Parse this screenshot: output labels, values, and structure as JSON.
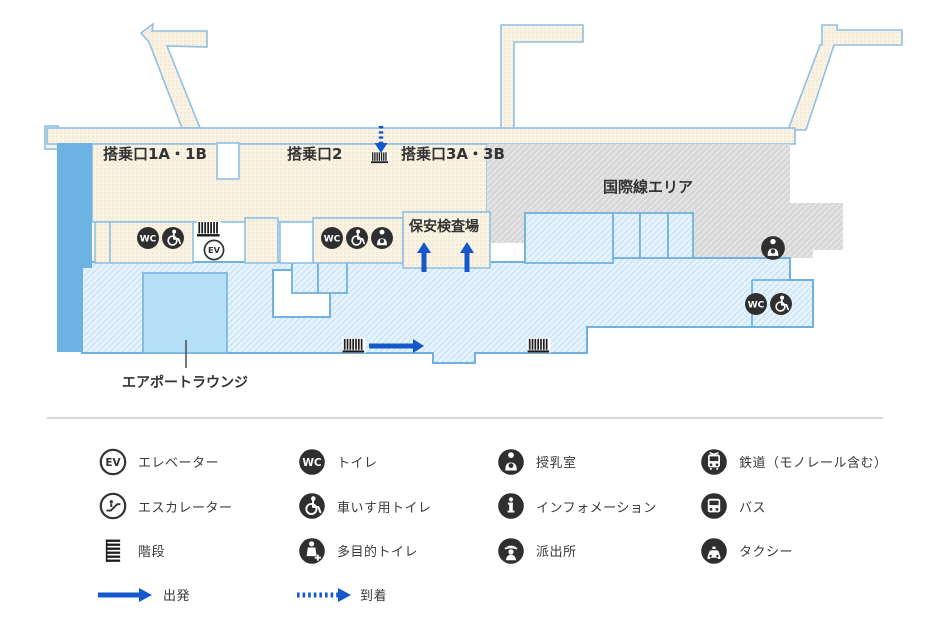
{
  "map": {
    "labels": {
      "gate_1a_1b": "搭乗口1A・1B",
      "gate_2": "搭乗口2",
      "gate_3a_3b": "搭乗口3A・3B",
      "security_check": "保安検査場",
      "international_area": "国際線エリア",
      "airport_lounge": "エアポートラウンジ"
    },
    "icon_text": {
      "elevator": "EV",
      "toilet": "WC"
    },
    "colors": {
      "departure_fill": "#faf3e3",
      "arrival_fill": "#e7f3fc",
      "international_fill": "#d8d8d8",
      "map_outline": "#72b1df",
      "solid_blue_zone": "#6cb2e2",
      "lounge_fill": "#b5dff7",
      "arrow_blue": "#1458cc",
      "icon_dark": "#2f2f31"
    }
  },
  "legend": {
    "columns": [
      {
        "items": [
          {
            "icon": "elevator-icon",
            "label": "エレベーター"
          },
          {
            "icon": "escalator-icon",
            "label": "エスカレーター"
          },
          {
            "icon": "stairs-icon",
            "label": "階段"
          },
          {
            "icon": "departure-arrow",
            "label": "出発"
          }
        ]
      },
      {
        "items": [
          {
            "icon": "toilet-icon",
            "label": "トイレ"
          },
          {
            "icon": "wheelchair-toilet-icon",
            "label": "車いす用トイレ"
          },
          {
            "icon": "multipurpose-toilet-icon",
            "label": "多目的トイレ"
          },
          {
            "icon": "arrival-arrow",
            "label": "到着"
          }
        ]
      },
      {
        "items": [
          {
            "icon": "nursing-room-icon",
            "label": "授乳室"
          },
          {
            "icon": "information-icon",
            "label": "インフォメーション"
          },
          {
            "icon": "police-box-icon",
            "label": "派出所"
          }
        ]
      },
      {
        "items": [
          {
            "icon": "train-icon",
            "label": "鉄道（モノレール含む）"
          },
          {
            "icon": "bus-icon",
            "label": "バス"
          },
          {
            "icon": "taxi-icon",
            "label": "タクシー"
          }
        ]
      }
    ]
  }
}
